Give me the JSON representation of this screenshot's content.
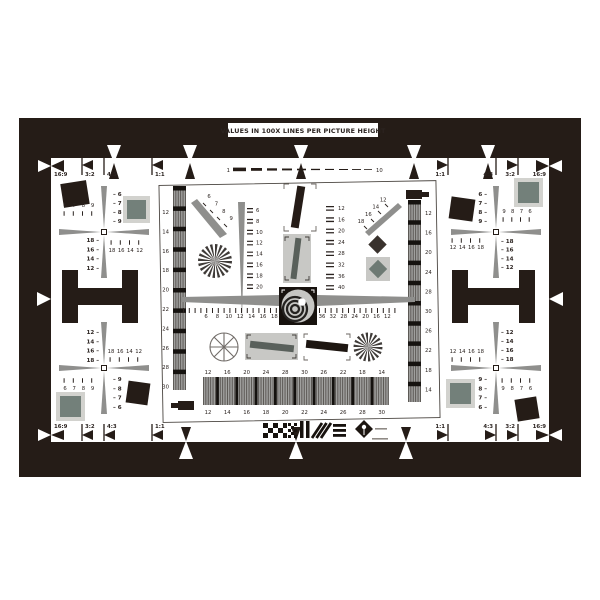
{
  "banner": {
    "title": "VALUES IN 100X LINES PER PICTURE HEIGHT"
  },
  "dash_scale": {
    "start": "1",
    "end": "10"
  },
  "aspect_labels": {
    "top_left": [
      "16:9",
      "3:2",
      "4:3",
      "1:1"
    ],
    "top_right": [
      "1:1",
      "4:3",
      "3:2",
      "16:9"
    ],
    "bottom_left": [
      "16:9",
      "3:2",
      "4:3",
      "1:1"
    ],
    "bottom_right": [
      "1:1",
      "4:3",
      "3:2",
      "16:9"
    ]
  },
  "scales": {
    "left_bar": [
      "12",
      "14",
      "16",
      "18",
      "20",
      "22",
      "24",
      "26",
      "28",
      "30"
    ],
    "right_bar": [
      "12",
      "16",
      "20",
      "24",
      "28",
      "30",
      "26",
      "22",
      "18",
      "14"
    ],
    "mid_left_wedge": [
      "6",
      "8",
      "10",
      "12",
      "14",
      "16",
      "18",
      "20"
    ],
    "mid_scale": [
      "12",
      "16",
      "20",
      "24",
      "28",
      "32",
      "36",
      "40"
    ],
    "diag_upper_left": [
      "6",
      "7",
      "8",
      "9"
    ],
    "diag_upper_right": [
      "18",
      "16",
      "14",
      "12"
    ],
    "center_h_left": [
      "6",
      "8",
      "10",
      "12",
      "14",
      "16",
      "18"
    ],
    "center_h_right": [
      "36",
      "32",
      "28",
      "24",
      "20",
      "16",
      "12"
    ],
    "bottom_bar_top": [
      "12",
      "16",
      "20",
      "24",
      "28",
      "30",
      "26",
      "22",
      "18",
      "14"
    ],
    "bottom_bar_bottom": [
      "12",
      "14",
      "16",
      "18",
      "20",
      "22",
      "24",
      "26",
      "28",
      "30"
    ]
  },
  "corners": {
    "top_left": {
      "top_nums": [
        "6",
        "7",
        "8",
        "9"
      ],
      "right_nums": [
        "6",
        "7",
        "8",
        "9"
      ],
      "left_nums": [
        "18",
        "16",
        "14",
        "12"
      ],
      "bottom_nums": [
        "18",
        "16",
        "14",
        "12"
      ]
    },
    "top_right": {
      "left_dash_nums": [
        "6",
        "7",
        "8",
        "9"
      ],
      "top_nums": [
        "9",
        "8",
        "7",
        "6"
      ],
      "bottom_nums": [
        "12",
        "14",
        "16",
        "18"
      ],
      "right_dash_nums": [
        "18",
        "16",
        "14",
        "12"
      ]
    },
    "bottom_left": {
      "left_nums": [
        "12",
        "14",
        "16",
        "18"
      ],
      "top_nums": [
        "18",
        "16",
        "14",
        "12"
      ],
      "bottom_nums": [
        "6",
        "7",
        "8",
        "9"
      ],
      "right_dash_nums": [
        "9",
        "8",
        "7",
        "6"
      ]
    },
    "bottom_right": {
      "top_nums": [
        "12",
        "14",
        "16",
        "18"
      ],
      "right_dash_nums": [
        "12",
        "14",
        "16",
        "18"
      ],
      "left_dash_nums": [
        "9",
        "8",
        "7",
        "6"
      ],
      "bottom_nums": [
        "9",
        "8",
        "7",
        "6"
      ]
    }
  },
  "colors": {
    "frame": "#251c17",
    "patch_inner": "#73807a",
    "patch_frame": "#d2d2ce",
    "wedge_gray": "#8f8f8d",
    "grating_base": "#a0a09e"
  }
}
